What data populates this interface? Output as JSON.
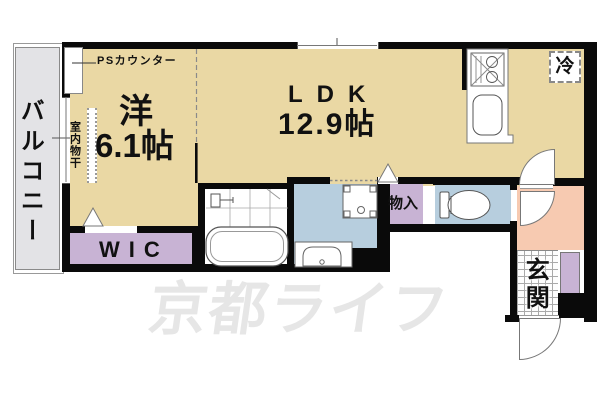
{
  "plan": {
    "balcony": "バルコニー",
    "western_room": {
      "name": "洋",
      "area": "6.1帖"
    },
    "ldk": {
      "name": "LDK",
      "area": "12.9帖"
    },
    "wic": "WIC",
    "storage": "物入",
    "entrance": "玄関",
    "refrigerator": "冷",
    "ps_counter": "PSカウンター",
    "indoor_drying": "室内物干"
  },
  "watermark": "京都ライフ",
  "colors": {
    "room": "#ead8a4",
    "closet": "#c8b3d4",
    "sanitary": "#b7cede",
    "entrance_hall": "#f7cab1",
    "balcony": "#e3e3e6",
    "wall": "#0a0a0a",
    "watermark": "#e6e6e6"
  }
}
